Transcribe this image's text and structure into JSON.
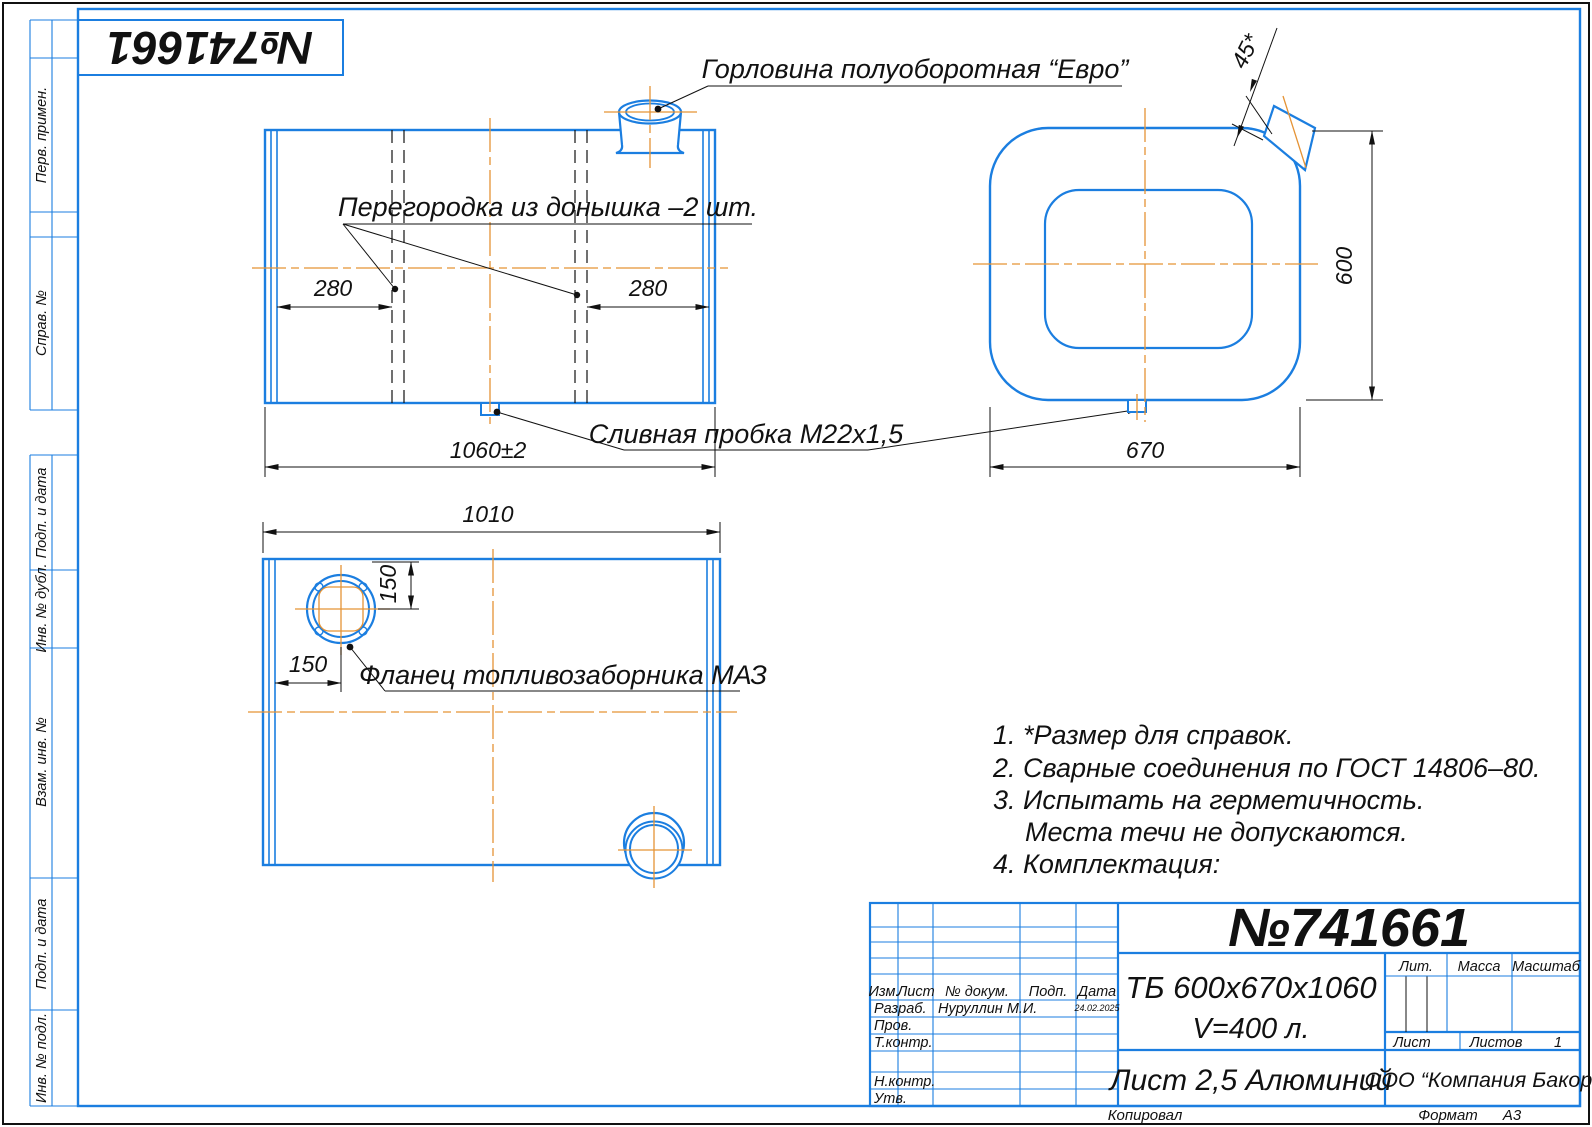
{
  "colors": {
    "blue": "#1b7ee0",
    "orange": "#e59335",
    "ink": "#111111"
  },
  "corner_stamp": "№741661",
  "margin_labels": {
    "perv": "Перв. примен.",
    "sprav": "Справ. №",
    "podp1": "Подп. и дата",
    "inv_dubl": "Инв. № дубл.",
    "vzam": "Взам. инв. №",
    "podp2": "Подп. и дата",
    "inv_podl": "Инв. № подл."
  },
  "views": {
    "front": {
      "label_neck": "Горловина полуоборотная “Евро”",
      "label_partition": "Перегородка из донышка –2 шт.",
      "label_drain": "Сливная пробка М22х1,5",
      "dim_left": "280",
      "dim_right": "280",
      "dim_width": "1060±2"
    },
    "side": {
      "dim_chamfer": "45*",
      "dim_height": "600",
      "dim_width": "670"
    },
    "bottom": {
      "dim_width": "1010",
      "dim_flange_y": "150",
      "dim_flange_x": "150",
      "label_flange": "Фланец топливозаборника МАЗ"
    }
  },
  "notes": {
    "n1": "1. *Размер для справок.",
    "n2": "2. Сварные соединения по ГОСТ 14806–80.",
    "n3": "3. Испытать на герметичность.",
    "n3b": "Места течи не допускаются.",
    "n4": "4. Комплектация:"
  },
  "title_block": {
    "doc_number": "№741661",
    "designation": "ТБ 600х670х1060",
    "volume": "V=400 л.",
    "material": "Лист 2,5 Алюминий",
    "company": "ООО “Компания Бакор”",
    "headers": {
      "izm": "Изм.",
      "list": "Лист",
      "doc": "№ докум.",
      "podp": "Подп.",
      "data": "Дата"
    },
    "rows": {
      "razrab": "Разраб.",
      "developer": "Нуруллин М.И.",
      "date": "24.02.2025",
      "prov": "Пров.",
      "tkontr": "Т.контр.",
      "nkontr": "Н.контр.",
      "utv": "Утв."
    },
    "lit": "Лит.",
    "mass": "Масса",
    "scale": "Масштаб",
    "sheet_label": "Лист",
    "sheets_label": "Листов",
    "sheets_value": "1",
    "footer": {
      "copied": "Копировал",
      "format_label": "Формат",
      "format_value": "А3"
    }
  }
}
